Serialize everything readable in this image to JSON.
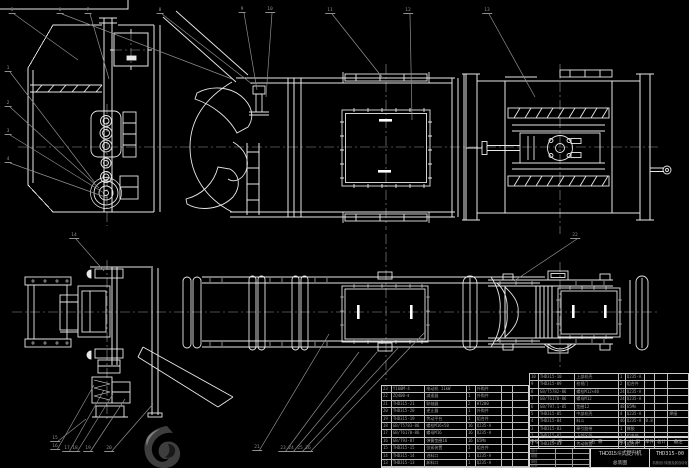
{
  "colors": {
    "background": "#000000",
    "line": "#e8e8e8",
    "leader": "#8f8f8f",
    "table_line": "#c8c8c8",
    "text": "#9f9f9f"
  },
  "title_block": {
    "product": "THD315斗式提升机",
    "doc_type": "总装图",
    "drawing_no": "THD315-00",
    "org": "机械设计制造及其自动化",
    "sig_rows": [
      "设计",
      "制图",
      "审核",
      "批准"
    ]
  },
  "bom": {
    "headers": [
      "序号",
      "代 号",
      "名 称",
      "数量",
      "材 料",
      "单件",
      "总计",
      "备注"
    ],
    "right_rows": [
      [
        "10",
        "THD315-10",
        "上部机壳",
        "1",
        "Q235-A",
        "",
        "",
        ""
      ],
      [
        "9",
        "THD315-09",
        "检视门",
        "2",
        "组合件",
        "",
        "",
        ""
      ],
      [
        "8",
        "GB/T5782-86",
        "螺栓M12×40",
        "24",
        "Q235-A",
        "",
        "",
        ""
      ],
      [
        "7",
        "GB/T6170-86",
        "螺母M12",
        "24",
        "Q235-A",
        "",
        "",
        ""
      ],
      [
        "6",
        "GB/T97.1-85",
        "垫圈12",
        "48",
        "65Mn",
        "",
        "",
        ""
      ],
      [
        "5",
        "THD315-05",
        "中部机壳",
        "4",
        "Q235-A",
        "",
        "",
        "焊接"
      ],
      [
        "4",
        "THD315-04",
        "料斗",
        "46",
        "Q235-A",
        "0.8",
        "",
        ""
      ],
      [
        "3",
        "THD315-03",
        "牵引胶带",
        "1",
        "橡胶",
        "",
        "",
        ""
      ],
      [
        "2",
        "THD315-02",
        "下部区段",
        "1",
        "组合件",
        "",
        "",
        ""
      ],
      [
        "1",
        "THD315-01",
        "传动装置",
        "1",
        "组合件",
        "",
        "",
        ""
      ]
    ],
    "left_rows": [
      [
        "23",
        "Y160M-4",
        "电动机 11kW",
        "1",
        "外购件",
        "",
        ""
      ],
      [
        "22",
        "ZQ400-Ⅱ",
        "减速器",
        "1",
        "外购件",
        "",
        ""
      ],
      [
        "21",
        "THD315-21",
        "联轴器",
        "2",
        "HT200",
        "",
        ""
      ],
      [
        "20",
        "THD315-20",
        "逆止器",
        "1",
        "外购件",
        "",
        ""
      ],
      [
        "19",
        "THD315-19",
        "传动平台",
        "1",
        "组合件",
        "",
        ""
      ],
      [
        "18",
        "GB/T5783-86",
        "螺栓M16×50",
        "16",
        "Q235-A",
        "",
        ""
      ],
      [
        "17",
        "GB/T6170-86",
        "螺母M16",
        "16",
        "Q235-A",
        "",
        ""
      ],
      [
        "16",
        "GB/T93-87",
        "弹簧垫圈16",
        "16",
        "65Mn",
        "",
        ""
      ],
      [
        "15",
        "THD315-15",
        "张紧装置",
        "1",
        "组合件",
        "",
        ""
      ],
      [
        "14",
        "THD315-14",
        "进料口",
        "1",
        "Q235-A",
        "",
        ""
      ],
      [
        "13",
        "THD315-13",
        "卸料口",
        "1",
        "Q235-A",
        "",
        ""
      ],
      [
        "12",
        "THD315-12",
        "护罩",
        "1",
        "Q235-A",
        "",
        ""
      ],
      [
        "11",
        "THD315-11",
        "机架",
        "1",
        "组合件",
        "",
        ""
      ]
    ]
  },
  "callouts": [
    {
      "n": "1",
      "x": 8,
      "y": 66,
      "tx": 95,
      "ty": 183
    },
    {
      "n": "2",
      "x": 8,
      "y": 101,
      "tx": 99,
      "ty": 188
    },
    {
      "n": "3",
      "x": 8,
      "y": 129,
      "tx": 104,
      "ty": 193
    },
    {
      "n": "4",
      "x": 8,
      "y": 157,
      "tx": 108,
      "ty": 198
    },
    {
      "n": "5",
      "x": 12,
      "y": 8,
      "tx": 78,
      "ty": 60
    },
    {
      "n": "6",
      "x": 60,
      "y": 8,
      "tx": 232,
      "ty": 79
    },
    {
      "n": "7",
      "x": 88,
      "y": 8,
      "tx": 109,
      "ty": 79
    },
    {
      "n": "8",
      "x": 160,
      "y": 8,
      "tx": 252,
      "ty": 84
    },
    {
      "n": "9",
      "x": 242,
      "y": 7,
      "tx": 257,
      "ty": 90
    },
    {
      "n": "10",
      "x": 270,
      "y": 7,
      "tx": 266,
      "ty": 97
    },
    {
      "n": "11",
      "x": 330,
      "y": 8,
      "tx": 382,
      "ty": 77
    },
    {
      "n": "12",
      "x": 408,
      "y": 8,
      "tx": 412,
      "ty": 120
    },
    {
      "n": "13",
      "x": 487,
      "y": 8,
      "tx": 535,
      "ty": 97
    },
    {
      "n": "14",
      "x": 74,
      "y": 233,
      "tx": 104,
      "ty": 271
    },
    {
      "n": "22",
      "x": 575,
      "y": 233,
      "tx": 514,
      "ty": 281
    },
    {
      "n": "15",
      "x": 55,
      "y": 436,
      "tx": 86,
      "ty": 419
    },
    {
      "n": "16",
      "x": 55,
      "y": 444,
      "tx": 94,
      "ty": 385
    },
    {
      "n": "17",
      "x": 67,
      "y": 446,
      "tx": 104,
      "ty": 390
    },
    {
      "n": "18",
      "x": 75,
      "y": 446,
      "tx": 113,
      "ty": 394
    },
    {
      "n": "19",
      "x": 88,
      "y": 446,
      "tx": 125,
      "ty": 399
    },
    {
      "n": "20",
      "x": 109,
      "y": 446,
      "tx": 153,
      "ty": 404
    },
    {
      "n": "21",
      "x": 257,
      "y": 445,
      "tx": 329,
      "ty": 334
    },
    {
      "n": "23",
      "x": 283,
      "y": 446,
      "tx": 359,
      "ty": 352
    },
    {
      "n": "24",
      "x": 291,
      "y": 446,
      "tx": 377,
      "ty": 352
    },
    {
      "n": "25",
      "x": 300,
      "y": 446,
      "tx": 398,
      "ty": 348
    },
    {
      "n": "26",
      "x": 308,
      "y": 446,
      "tx": 426,
      "ty": 331
    }
  ]
}
